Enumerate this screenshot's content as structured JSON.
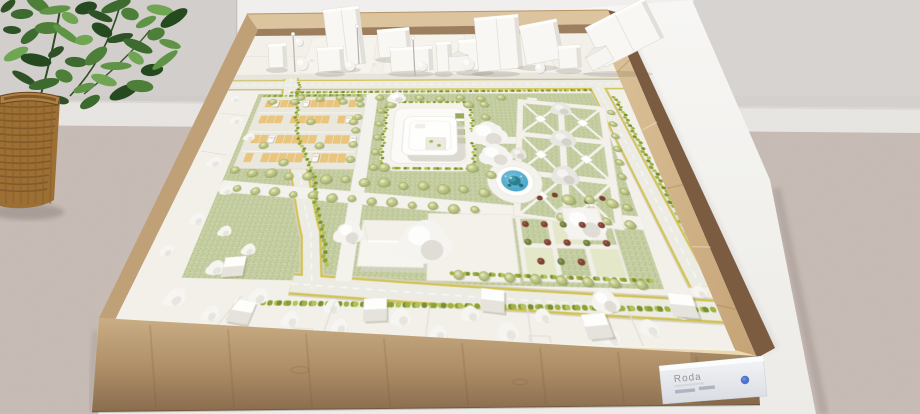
{
  "scene": {
    "type": "photograph",
    "subject": "Architectural scale model of a landscaped site master plan displayed in a plywood box",
    "setting": "Exhibition corner with grey wall, beige floor, white display table, potted plant in a wicker basket"
  },
  "exhibit_label": {
    "title": "Roda"
  },
  "palette": {
    "wall": "#d6d3d1",
    "baseboard": "#eae8e5",
    "floor": "#c8bdb6",
    "table": "#f4f3f0",
    "plywood_light": "#dfc9a4",
    "plywood_mid": "#cfb087",
    "plywood_shadow": "#8a6a4b",
    "model_ground": "#f2f0e9",
    "lawn": "#c5cea2",
    "hedge": "#9fb23f",
    "road": "#edece4",
    "road_marking": "#d2c24e",
    "parking_stall": "#eac57b",
    "pond_blue": "#4aa6c9",
    "sculpture_teal": "#2e7f8e",
    "tree_olive": "#b4bd7d",
    "tree_white": "#f6f5f1",
    "shrub_red": "#7e4233",
    "building_white": "#fbfaf6",
    "label_card": "#e9ebf0",
    "label_text": "#8f949c",
    "logo_blue": "#3d66c4",
    "plant_leaf": "#3c6a2f",
    "basket_wicker": "#9c6f34"
  },
  "model_features": [
    "perimeter road with yellow edge markings",
    "tree-lined avenue",
    "parking lot with tan stalls",
    "main building on hedged terrace",
    "circular fountain plaza with blue pond and teal sculpture",
    "formal parterre garden with diagonal paths",
    "pitched-roof hall",
    "white blossom trees",
    "olive-green trees",
    "white context buildings",
    "wicker plant basket",
    "exhibit label card"
  ]
}
